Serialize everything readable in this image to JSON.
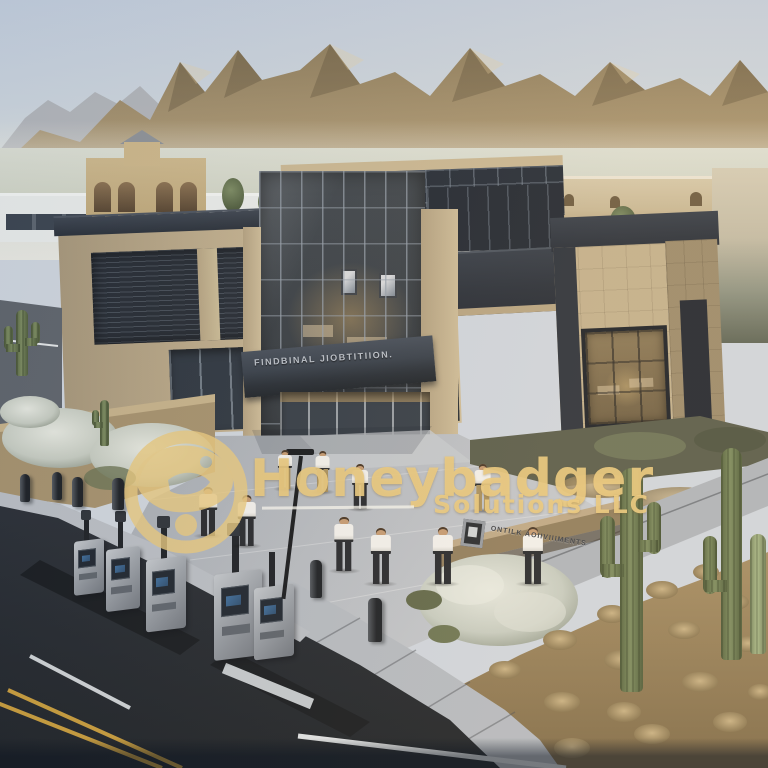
{
  "watermark": {
    "brand": "Honeybadger",
    "subtitle": "Solutions LLC",
    "logo": "honeybadger-badge-logo",
    "color": "#e9cb80"
  },
  "signs": {
    "entrance_canopy": "FINDBINAL JIOBTITIION.",
    "landscape_wall": "ONTILK AOIIVIIIMENTS"
  },
  "palette": {
    "sky_top": "#c3cedd",
    "haze": "#e9e9e2",
    "mountain": "#9c8a66",
    "building_tan": "#c2b08d",
    "glass_dark": "#2b3440",
    "concrete": "#b8bdc4",
    "asphalt": "#23272e",
    "lane_yellow": "#c79b3a",
    "desert_dirt": "#9c8560",
    "cactus_green": "#6e7d55",
    "watermark_gold": "#e9cb80"
  }
}
